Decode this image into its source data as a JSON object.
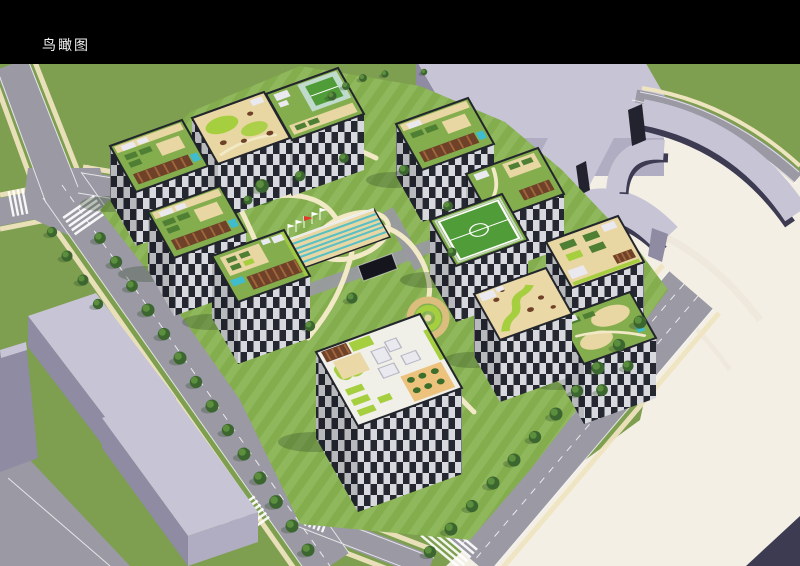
{
  "frame": {
    "background": "#000000"
  },
  "header": {
    "title": "鸟瞰图",
    "title_color": "#f2f2f2"
  },
  "render": {
    "type": "architectural-aerial-rendering",
    "subject": "residential-block-bird-eye-view",
    "palette": {
      "bg": "#000000",
      "title_color": "#f2f2f2",
      "grass": "#7d9f4f",
      "lawn_a": "#84ad4e",
      "lawn_b": "#8fb75b",
      "road": "#9a99a4",
      "road_line": "#ffffff",
      "sidewalk": "#efe4c0",
      "plaza": "#f4efe5",
      "plaza_wave": "#e9e2d3",
      "ctx_top": "#c7c4d6",
      "ctx_front": "#b0adc2",
      "ctx_side": "#8e8ba3",
      "ctx_dark": "#3c3b52",
      "ctx_deep": "#23222f",
      "facade_dark": "#272a33",
      "facade_light": "#e8e9ee",
      "parapet": "#23252c",
      "roof_tan": "#e9d7a3",
      "roof_cream": "#f0efe8",
      "trellis": "#6e4128",
      "trellis_slat": "#a0663c",
      "pool": "#3fbccd",
      "plots": "#4e7f33",
      "lime": "#a5cf3f",
      "field": "#4f9c38",
      "sand": "#ead8a6",
      "terrace": "#edc27c",
      "table_green": "#3a6e2a",
      "tree_dark": "#3c662f",
      "tree_light": "#5b8f3d",
      "shadow": "#2f4a26",
      "flag_red": "#e03a2a",
      "box_white": "#e9e9ef",
      "path_cream": "#f2e9c6",
      "oval_ring": "#dbbd7e",
      "ramp_dark": "#15151d"
    }
  }
}
